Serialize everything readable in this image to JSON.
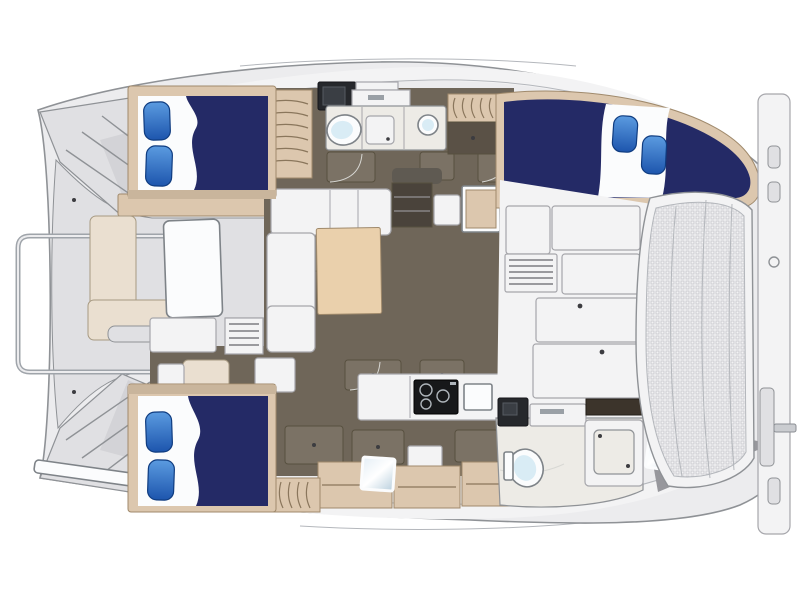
{
  "title": "catamaran-interior-deck-plan",
  "colors": {
    "navy": "#242a66",
    "pillow-light": "#5b9be0",
    "pillow-dark": "#1d55ad",
    "pillow-stroke": "#0f3c80",
    "wood": "#dcc7ae",
    "wood-edge": "#a08a6c",
    "wood-slat": "#8a765c",
    "table-wood": "#ead0ac",
    "floor": "#6f6659",
    "floor-door": "#7b7265",
    "floor-edge": "#57503f",
    "arc-line": "#d8d8d4",
    "deck": "#ececee",
    "deck-dark": "#e0e0e3",
    "deck-darker": "#d3d3d7",
    "deck-stroke": "#8f9296",
    "white-f": "#f3f3f4",
    "white-stroke": "#a6a6ab",
    "cream": "#eadfd0",
    "cream-stroke": "#a79a82",
    "counter-dark": "#26282c",
    "counter-brown": "#3c342b",
    "porcelain": "#fbfcfd",
    "fixture-stroke": "#7e8388",
    "aqua": "#d9ecf5",
    "glass-light": "#e4eef5",
    "glass-dark": "#b9cfdd",
    "head-floor": "#edebe6",
    "mesh-bg": "#f2f2f3",
    "mesh-dot": "#c7c7cc",
    "stove": "#17181a",
    "closet": "#5a5146",
    "steps-dark": "#4a433b",
    "shadow-line": "#b4b7bc",
    "rail": "#9fa4aa",
    "handle": "#3c3c40",
    "louver": "#9a9a9e"
  },
  "features": [
    "double-berth",
    "pillow",
    "bed-sheet",
    "toilet",
    "shower-pan",
    "round-sink",
    "vanity-counter",
    "galley-stove",
    "galley-sink",
    "salon-sofa",
    "dining-table",
    "cockpit-bench",
    "louvered-table",
    "wood-steps",
    "cabinet-door",
    "trampoline-net",
    "boarding-rail",
    "transom-steps",
    "deck-hatch",
    "glass-hatch",
    "davit-pole"
  ]
}
